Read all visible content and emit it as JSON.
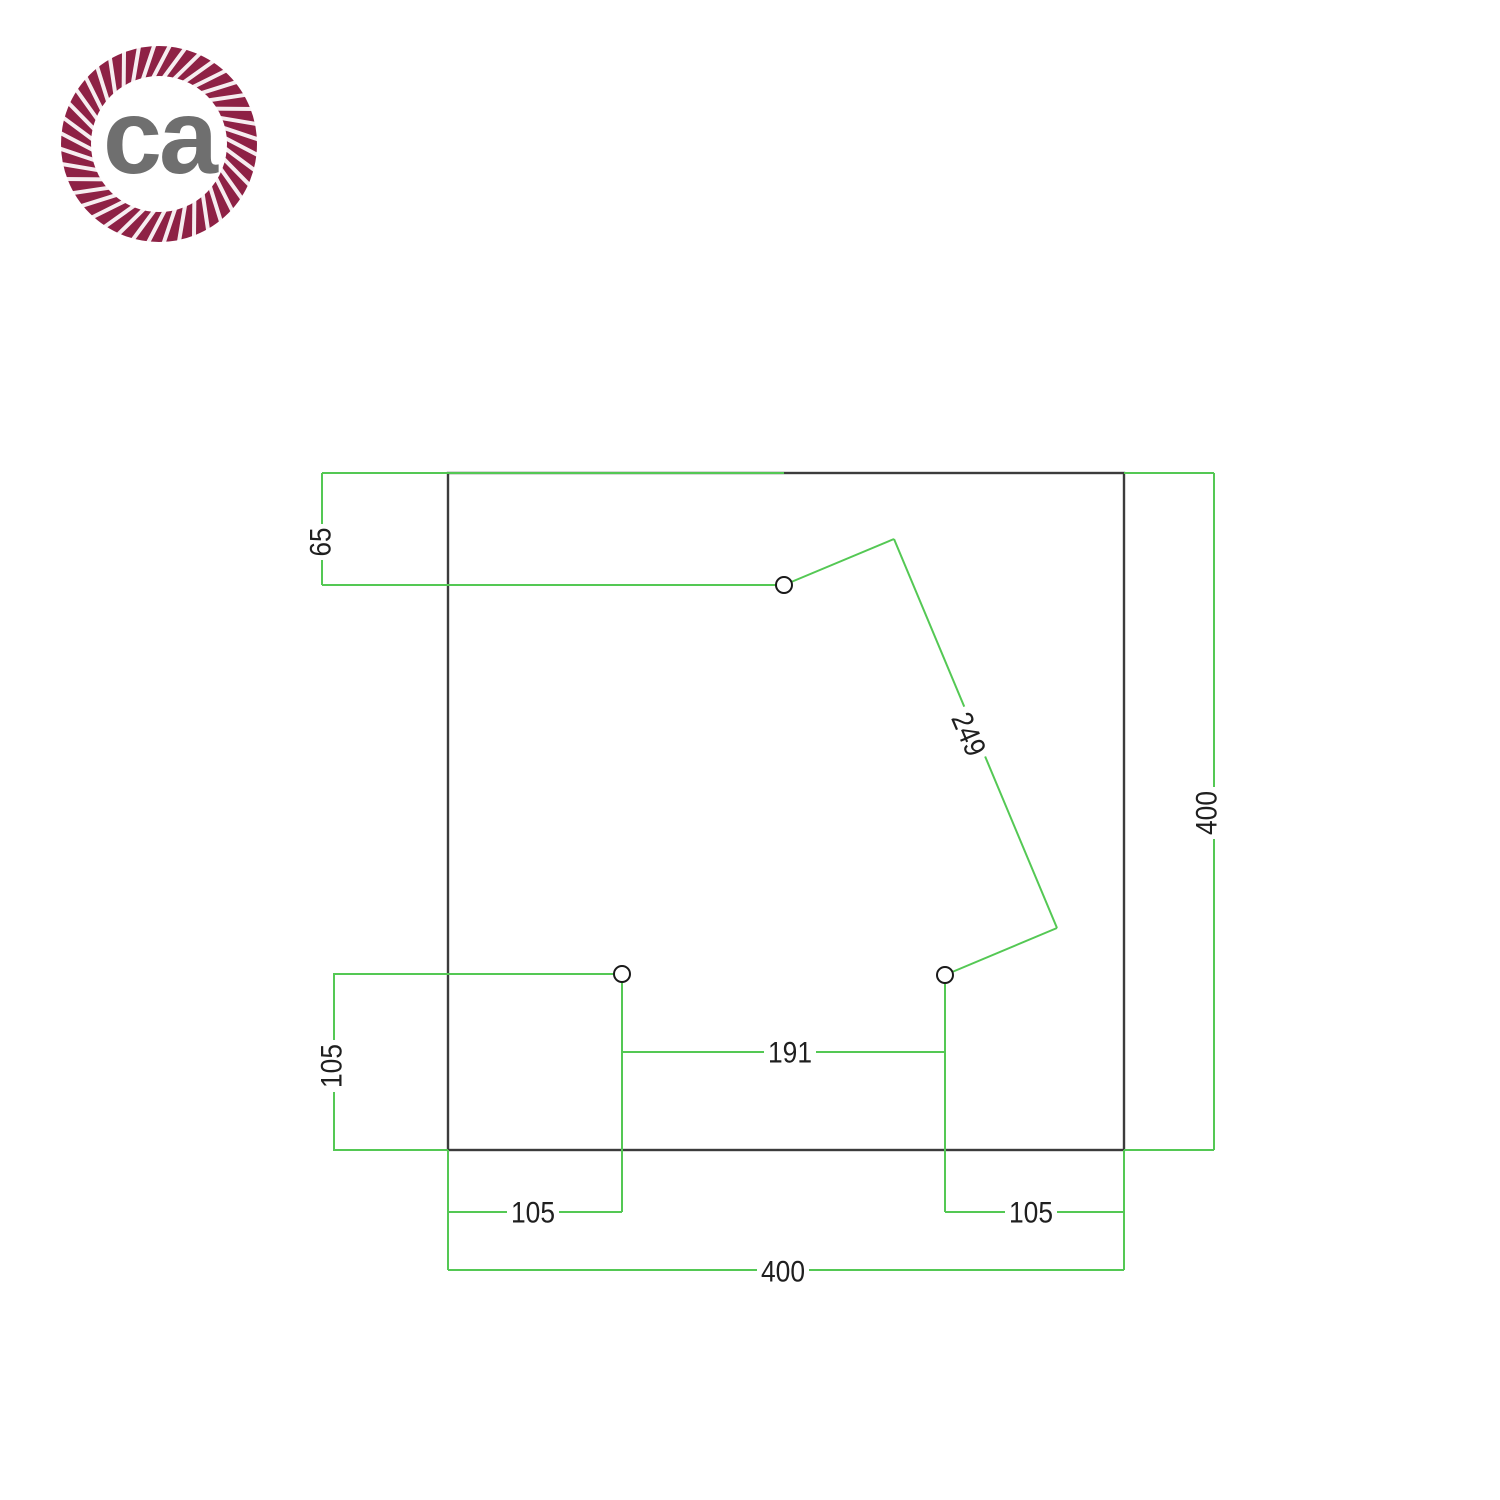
{
  "logo": {
    "text": "ca",
    "rope_color": "#8e2145",
    "letters_color": "#6f6f6f"
  },
  "drawing": {
    "title": "square-canopy-drilling-template",
    "outline_color": "#3c3c3c",
    "dimension_color": "#54c854",
    "label_color": "#1f1f1f",
    "hole_stroke": "#1a1a1a",
    "holes_count": 3,
    "labels": {
      "top_hole_offset": "65",
      "left_hole_offset": "105",
      "holes_spacing_bottom": "191",
      "holes_spacing_diagonal": "249",
      "bottom_left_hole_offset": "105",
      "bottom_right_hole_offset": "105",
      "plate_width": "400",
      "plate_height": "400"
    }
  }
}
